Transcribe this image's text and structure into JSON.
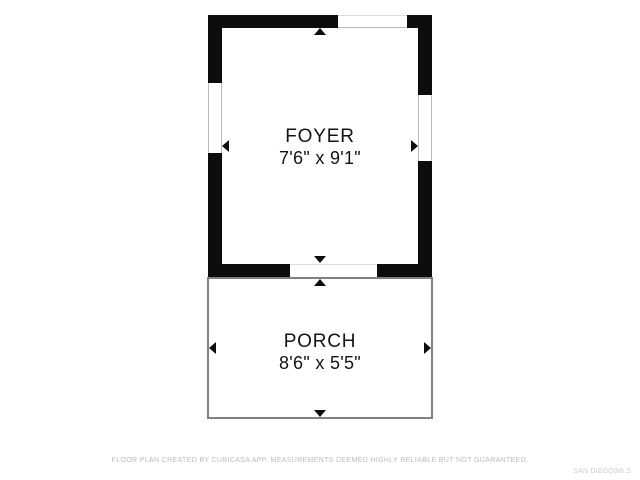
{
  "rooms": [
    {
      "id": "foyer",
      "name": "FOYER",
      "dimensions": "7'6\" x 9'1\""
    },
    {
      "id": "porch",
      "name": "PORCH",
      "dimensions": "8'6\" x 5'5\""
    }
  ],
  "footer": {
    "disclaimer": "FLOOR PLAN CREATED BY CUBICASA APP. MEASUREMENTS DEEMED HIGHLY RELIABLE BUT NOT GUARANTEED."
  },
  "watermark": {
    "text": "SAN DIEGO|MLS"
  },
  "colors": {
    "page_bg": "#ffffff",
    "wall": "#0d0d0d",
    "porch_outline": "#808080",
    "room_text": "#141414",
    "window_line": "#bbbbbb",
    "footer_text": "#bcbcbc",
    "watermark_text": "#cccccc"
  }
}
